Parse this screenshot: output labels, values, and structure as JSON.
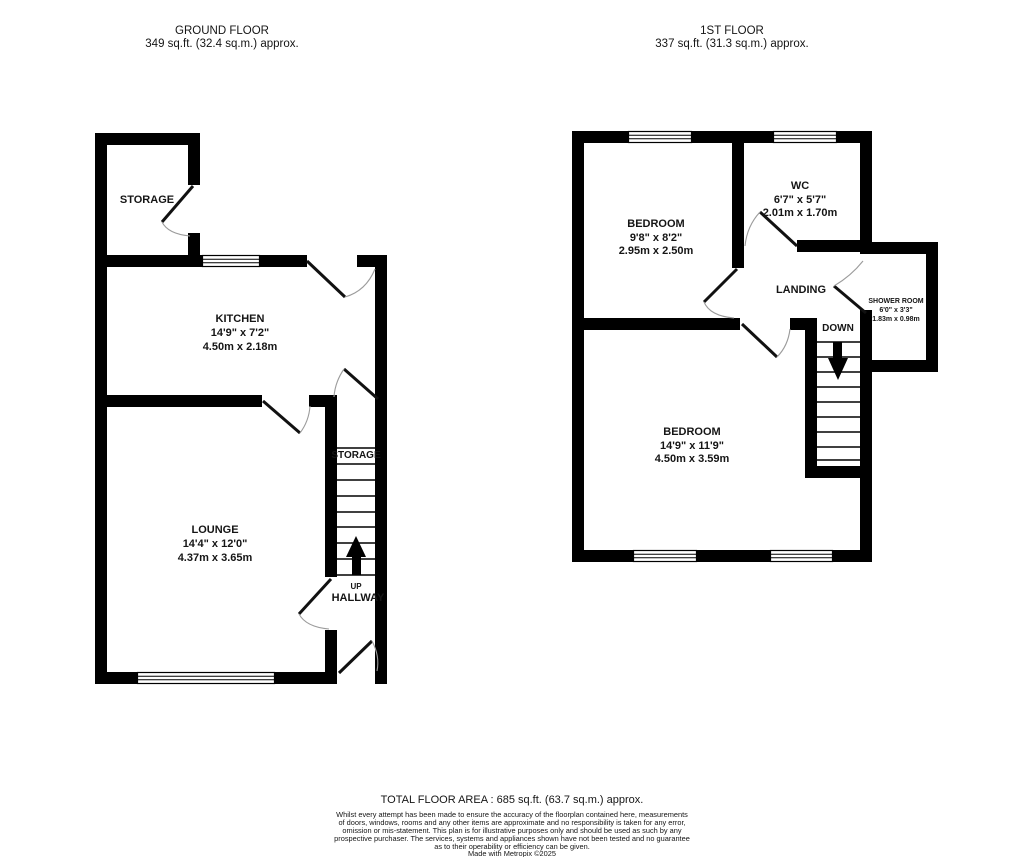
{
  "page": {
    "background": "#ffffff",
    "ink": "#000000",
    "arc_color": "#9b9b9b"
  },
  "header": {
    "ground": {
      "title": "GROUND FLOOR",
      "subtitle": "349 sq.ft. (32.4 sq.m.) approx."
    },
    "first": {
      "title": "1ST FLOOR",
      "subtitle": "337 sq.ft. (31.3 sq.m.) approx."
    }
  },
  "ground": {
    "storage": {
      "name": "STORAGE"
    },
    "kitchen": {
      "name": "KITCHEN",
      "imperial": "14'9\" x 7'2\"",
      "metric": "4.50m x 2.18m"
    },
    "lounge": {
      "name": "LOUNGE",
      "imperial": "14'4\" x 12'0\"",
      "metric": "4.37m x 3.65m"
    },
    "stairs_storage": "STORAGE",
    "up": "UP",
    "hallway": "HALLWAY"
  },
  "first": {
    "bedroom1": {
      "name": "BEDROOM",
      "imperial": "9'8\" x 8'2\"",
      "metric": "2.95m x 2.50m"
    },
    "wc": {
      "name": "WC",
      "imperial": "6'7\" x 5'7\"",
      "metric": "2.01m x 1.70m"
    },
    "landing": "LANDING",
    "shower": {
      "name": "SHOWER ROOM",
      "imperial": "6'0\" x 3'3\"",
      "metric": "1.83m x 0.98m"
    },
    "bedroom2": {
      "name": "BEDROOM",
      "imperial": "14'9\" x 11'9\"",
      "metric": "4.50m x 3.59m"
    },
    "down": "DOWN"
  },
  "footer": {
    "total": "TOTAL FLOOR AREA : 685 sq.ft. (63.7 sq.m.) approx.",
    "disclaimer": [
      "Whilst every attempt has been made to ensure the accuracy of the floorplan contained here, measurements",
      "of doors, windows, rooms and any other items are approximate and no responsibility is taken for any error,",
      "omission or mis-statement. This plan is for illustrative purposes only and should be used as such by any",
      "prospective purchaser. The services, systems and appliances shown have not been tested and no guarantee",
      "as to their operability or efficiency can be given."
    ],
    "credit": "Made with Metropix ©2025"
  }
}
